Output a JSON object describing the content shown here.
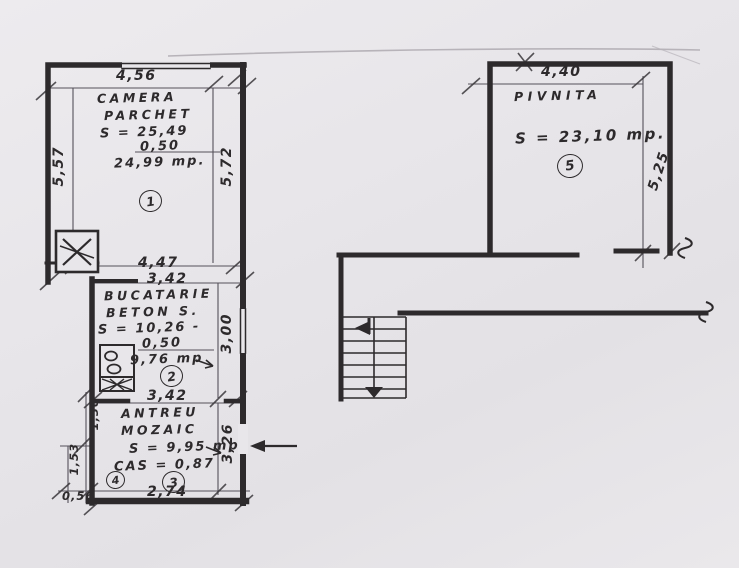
{
  "rooms": {
    "camera": {
      "name1": "CAMERA",
      "name2": "PARCHET",
      "area_gross": "S = 25,49",
      "deduction": "0,50",
      "area_net": "24,99 mp.",
      "number": "1",
      "dims": {
        "top": "4,56",
        "left": "5,57",
        "right": "5,72"
      }
    },
    "bucatarie": {
      "name1": "BUCATARIE",
      "name2": "BETON S.",
      "area_gross": "S = 10,26 -",
      "deduction": "0,50",
      "area_net": "9,76 mp",
      "number": "2",
      "dims": {
        "top_outer": "4,47",
        "top_inner": "3,42",
        "right": "3,00",
        "bottom": "3,42"
      }
    },
    "antreu": {
      "name1": "ANTREU",
      "name2": "MOZAIC",
      "area": "S = 9,95 mp",
      "coefficient": "CAS = 0,87",
      "number": "3",
      "number2": "4",
      "dims": {
        "right": "3,26",
        "bottom": "2,74",
        "bottom_left": "0,56",
        "left_upper": "1,30",
        "left_lower": "1,53"
      }
    },
    "pivnita": {
      "name1": "PIVNITA",
      "area": "S = 23,10 mp.",
      "number": "5",
      "dims": {
        "top": "4,40",
        "right": "5,25"
      }
    }
  },
  "icons": {
    "masonry_stove": "crossed-box-stove-symbol",
    "cooker": "two-burner-cooker-symbol",
    "stairs": "staircase-with-down-arrow",
    "entrance_arrow": "entrance-direction-arrow",
    "wall_break": "wall-break-squiggle"
  },
  "colors": {
    "paper": "#e8e6ea",
    "ink": "#2d2a2c",
    "pencil": "#b7b3b9",
    "dim_line": "#55515a"
  }
}
